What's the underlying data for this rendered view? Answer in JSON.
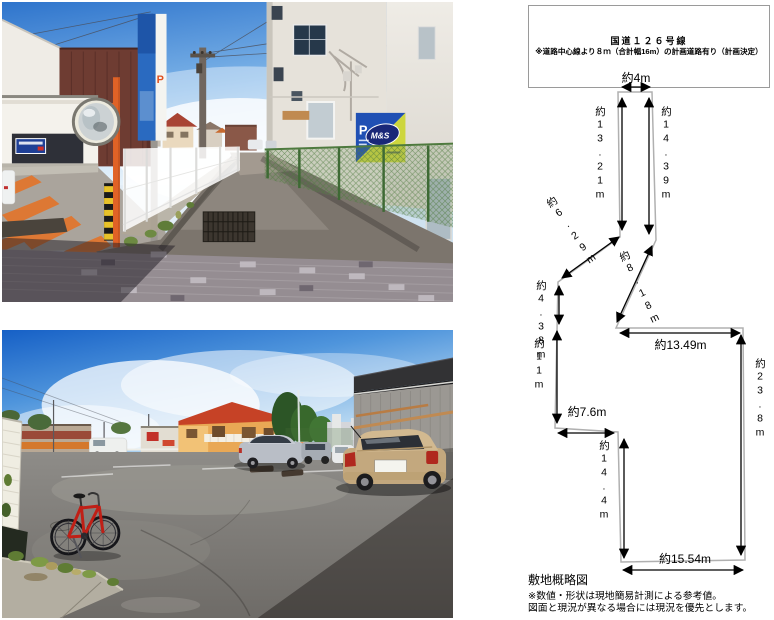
{
  "photos": {
    "street": {
      "vertical_sign_letter": "P",
      "corner_sign": {
        "letter": "P",
        "logo": "M&S"
      }
    },
    "parking": {}
  },
  "site_plan": {
    "road_box": {
      "line1": "国道１２６号線",
      "line2": "※道路中心線より８ｍ（合計幅16m）の計画道路有り（計画決定）"
    },
    "dims": {
      "top": "約4m",
      "pole_left": "約13.21m",
      "pole_right": "約14.39m",
      "diag_left": "約6.29m",
      "left_upper": "約4.38m",
      "left_lower": "約11m",
      "notch": "約7.6m",
      "diag_right": "約8.18m",
      "mid_horizontal": "約13.49m",
      "right_side": "約23.8m",
      "lower_left": "約14.4m",
      "bottom": "約15.54m"
    },
    "caption": "敷地概略図",
    "note1": "※数値・形状は現地簡易計測による参考値。",
    "note2": "図面と現況が異なる場合には現況を優先とします。"
  },
  "colors": {
    "boundary_line": "#b0b0b0",
    "arrow": "#000000",
    "road_box_border": "#9a9a9a"
  }
}
